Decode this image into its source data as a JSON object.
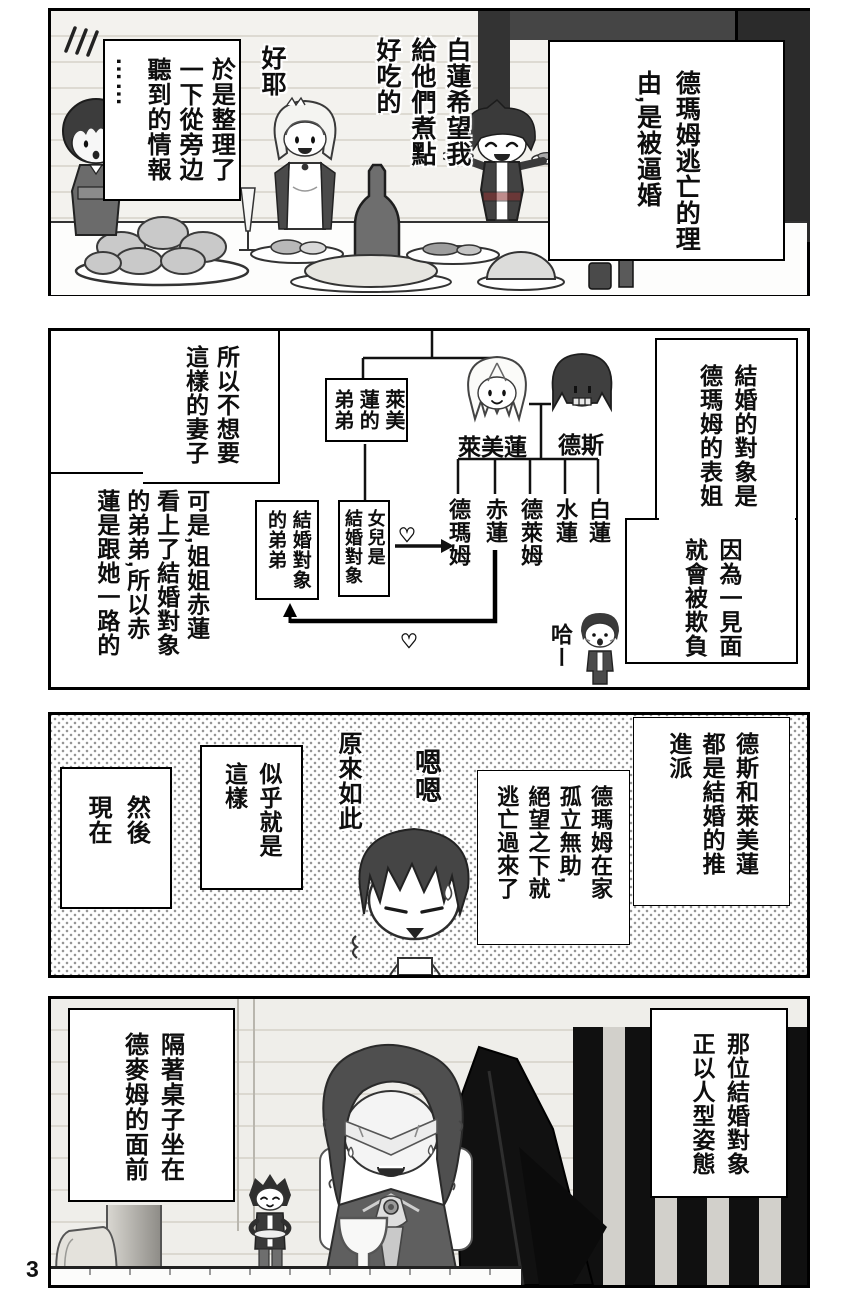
{
  "page": {
    "number": "3"
  },
  "panel1": {
    "narration_right": "德瑪姆逃亡的理\n由,是被逼婚",
    "narration_left": "於是整理了\n一下從旁边\n聽到的情報\n……",
    "speech_yay": "好耶",
    "speech_cook": "白蓮希望我\n給他們煮點\n好吃的"
  },
  "panel2": {
    "caption_partner": "結婚的對象是\n德瑪姆的表姐",
    "caption_bully": "因為一見面\n就會被欺負",
    "caption_wife": "所以不想要\n這樣的妻子",
    "caption_sister": "可是,姐姐赤蓮\n看上了結婚對象\n的弟弟,所以赤\n蓮是跟她一路的",
    "box_brother": "萊美\n蓮的\n弟弟",
    "box_daughter": "女兒是\n結婚對象",
    "box_partner_brother": "結婚對象\n的弟弟",
    "parents": {
      "mother": "萊美蓮",
      "father": "德斯"
    },
    "children": [
      "白蓮",
      "水蓮",
      "德萊姆",
      "赤蓮",
      "德瑪姆"
    ],
    "laugh": "哈ー",
    "heart_symbol": "♡"
  },
  "panel3": {
    "caption_push": "德斯和萊美蓮\n都是結婚的推\n進派",
    "caption_escape": "德瑪姆在家\n孤立無助,\n絕望之下就\n逃亡過來了",
    "speech_hmm": "嗯嗯",
    "speech_isee": "原來如此",
    "caption_seems": "似乎就是\n這樣",
    "caption_now": "然後\n現在"
  },
  "panel4": {
    "caption_partner_form": "那位結婚對象\n正以人型姿態",
    "caption_table": "隔著桌子坐在\n德麥姆的面前"
  }
}
